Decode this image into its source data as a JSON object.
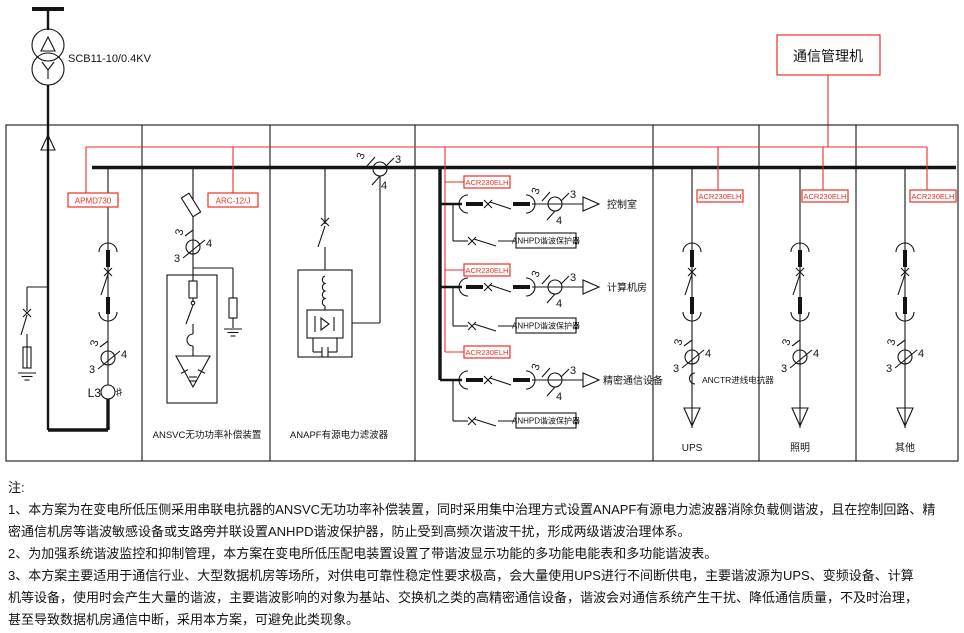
{
  "colors": {
    "red": "#ee2e24",
    "ink": "#141414"
  },
  "transformer_label": "SCB11-10/0.4KV",
  "comm_manager": "通信管理机",
  "device_labels": {
    "incoming_meter": "APMD730",
    "svc_controller": "ARC-12/J",
    "feeder_meter": "ACR230ELH"
  },
  "panel_labels": {
    "ansvc": "ANSVC无功功率补偿装置",
    "anapf": "ANAPF有源电力滤波器",
    "ups": "UPS",
    "lighting": "照明",
    "other": "其他"
  },
  "feeders": [
    {
      "label": "控制室"
    },
    {
      "label": "计算机房"
    },
    {
      "label": "精密通信设备"
    }
  ],
  "protector_label": "ANHPD谐波保护器",
  "reactor_label": "ANCTR进线电抗器",
  "ct_marks": {
    "phases": "3",
    "slash_three": "3",
    "four": "4"
  },
  "meter_phase": "L3",
  "meter_hash": "#",
  "notes": {
    "title": "注:",
    "lines": [
      "1、本方案为在变电所低压侧采用串联电抗器的ANSVC无功功率补偿装置，同时采用集中治理方式设置ANAPF有源电力滤波器消除负载侧谐波，且在控制回路、精",
      "密通信机房等谐波敏感设备或支路旁并联设置ANHPD谐波保护器，防止受到高频次谐波干扰，形成两级谐波治理体系。",
      "2、为加强系统谐波监控和抑制管理，本方案在变电所低压配电装置设置了带谐波显示功能的多功能电能表和多功能谐波表。",
      "3、本方案主要适用于通信行业、大型数据机房等场所，对供电可靠性稳定性要求极高，会大量使用UPS进行不间断供电，主要谐波源为UPS、变频设备、计算",
      "机等设备，使用时会产生大量的谐波，主要谐波影响的对象为基站、交换机之类的高精密通信设备，谐波会对通信系统产生干扰、降低通信质量，不及时治理，",
      "甚至导致数据机房通信中断，采用本方案，可避免此类现象。"
    ]
  }
}
